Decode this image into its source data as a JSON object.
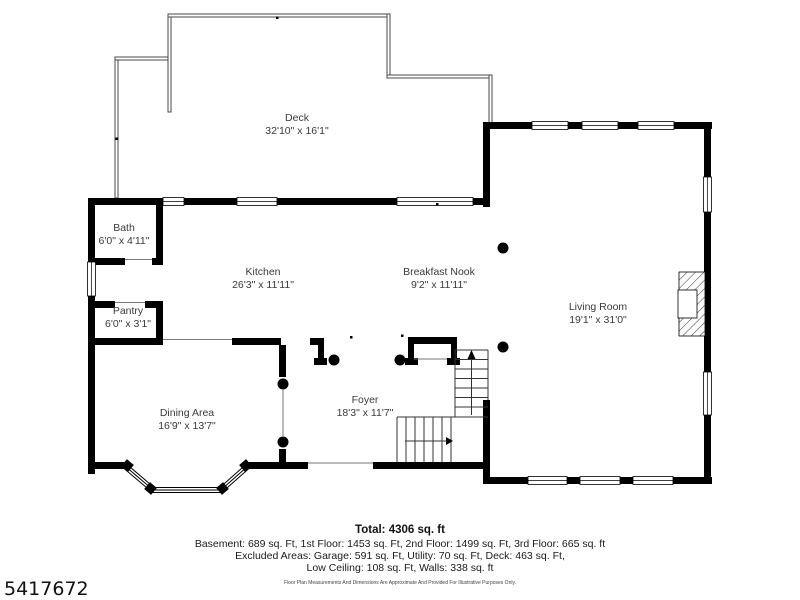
{
  "colors": {
    "wall": "#000000",
    "label": "#3a3a3a",
    "text": "#1a1a1a",
    "background": "#ffffff"
  },
  "rooms": [
    {
      "name": "Deck",
      "dims": "32'10\" x 16'1\""
    },
    {
      "name": "Bath",
      "dims": "6'0\" x 4'11\""
    },
    {
      "name": "Kitchen",
      "dims": "26'3\" x 11'11\""
    },
    {
      "name": "Breakfast Nook",
      "dims": "9'2\" x 11'11\""
    },
    {
      "name": "Living Room",
      "dims": "19'1\" x 31'0\""
    },
    {
      "name": "Pantry",
      "dims": "6'0\" x 3'1\""
    },
    {
      "name": "Dining Area",
      "dims": "16'9\" x 13'7\""
    },
    {
      "name": "Foyer",
      "dims": "18'3\" x 11'7\""
    }
  ],
  "summary": {
    "total": "Total: 4306 sq. ft",
    "line1": "Basement: 689 sq. Ft, 1st Floor: 1453 sq. Ft, 2nd Floor: 1499 sq. Ft, 3rd Floor: 665 sq. ft",
    "line2": "Excluded Areas: Garage: 591 sq. Ft, Utility: 70 sq. Ft, Deck: 463 sq. Ft,",
    "line3": "Low Ceiling: 108 sq. Ft, Walls: 338 sq. ft",
    "disclaimer": "Floor Plan Measurements And Dimensions Are Approximate And Provided For Illustrative Purposes Only."
  },
  "listing_id": "5417672"
}
